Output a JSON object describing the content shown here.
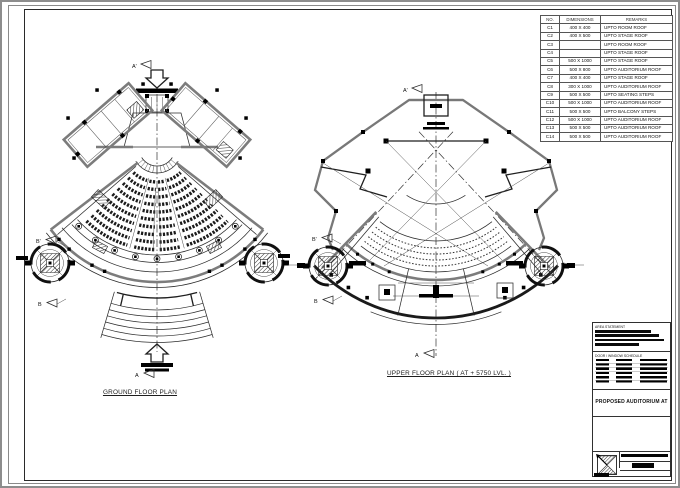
{
  "sheet": {
    "type": "architectural drawing sheet",
    "line_color": "#1a1a1a",
    "wall_color": "#7c7c7c",
    "background": "#ffffff"
  },
  "plans": [
    {
      "id": "ground",
      "label": "GROUND FLOOR PLAN"
    },
    {
      "id": "upper",
      "label": "UPPER FLOOR PLAN ( AT + 5750 LVL. )"
    }
  ],
  "markers": {
    "a_prime": "A'",
    "a": "A",
    "b_prime": "B'",
    "b": "B"
  },
  "column_schedule": {
    "headers": [
      "NO.",
      "DIMENSIONS",
      "REMARKS"
    ],
    "rows": [
      [
        "C1",
        "400 X 400",
        "UPTO ROOM ROOF"
      ],
      [
        "C2",
        "400 X 500",
        "UPTO STAGE ROOF"
      ],
      [
        "C3",
        "",
        "UPTO ROOM ROOF"
      ],
      [
        "C4",
        "",
        "UPTO STAGE ROOF"
      ],
      [
        "C5",
        "500 X 1000",
        "UPTO STAGE ROOF"
      ],
      [
        "C6",
        "500 X 800",
        "UPTO AUDITORIUM ROOF"
      ],
      [
        "C7",
        "400 X 400",
        "UPTO STAGE ROOF"
      ],
      [
        "C8",
        "300 X 1000",
        "UPTO AUDITORIUM ROOF"
      ],
      [
        "C9",
        "500 X 500",
        "UPTO SEATING STEPS"
      ],
      [
        "C10",
        "500 X 1000",
        "UPTO AUDITORIUM ROOF"
      ],
      [
        "C11",
        "500 X 500",
        "UPTO BALCONY STEPS"
      ],
      [
        "C12",
        "500 X 1000",
        "UPTO AUDITORIUM ROOF"
      ],
      [
        "C13",
        "500 X 500",
        "UPTO AUDITORIUM ROOF"
      ],
      [
        "C14",
        "500 X 500",
        "UPTO AUDITORIUM ROOF"
      ]
    ]
  },
  "title_block": {
    "area_statement_label": "AREA STATEMENT",
    "schedule_label": "DOOR / WINDOW SCHEDULE",
    "project_title": "PROPOSED AUDITORIUM AT"
  }
}
